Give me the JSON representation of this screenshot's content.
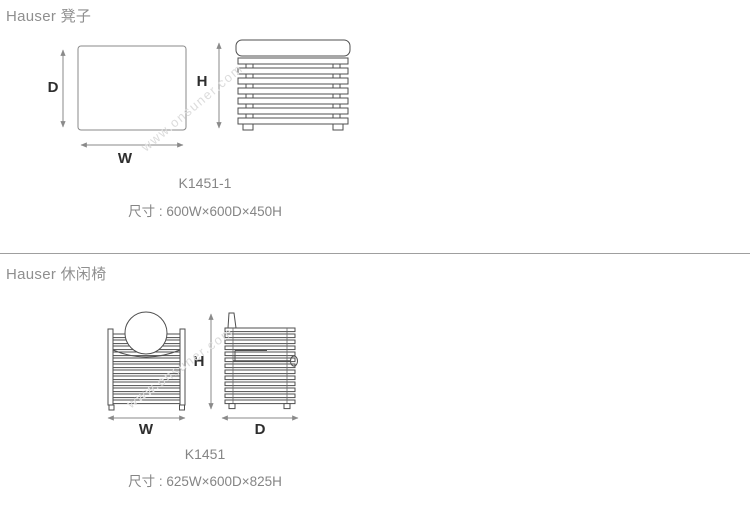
{
  "watermark": "www.onsuner.com",
  "sections": [
    {
      "heading": "Hauser 凳子",
      "product_code": "K1451-1",
      "size_text": "尺寸 : 600W×600D×450H",
      "labels": {
        "depth": "D",
        "width": "W",
        "height": "H"
      }
    },
    {
      "heading": "Hauser 休闲椅",
      "product_code": "K1451",
      "size_text": "尺寸 : 625W×600D×825H",
      "labels": {
        "width": "W",
        "height": "H",
        "depth": "D"
      }
    }
  ],
  "colors": {
    "heading_text": "#8f8f8f",
    "caption_text": "#858585",
    "drawing_dark_line": "#4f4f4f",
    "drawing_light_line": "#8a8a8a",
    "dimension_label": "#2e2e2e",
    "divider": "#9f9f9f",
    "watermark": "#dcdcdc",
    "background": "#ffffff"
  }
}
